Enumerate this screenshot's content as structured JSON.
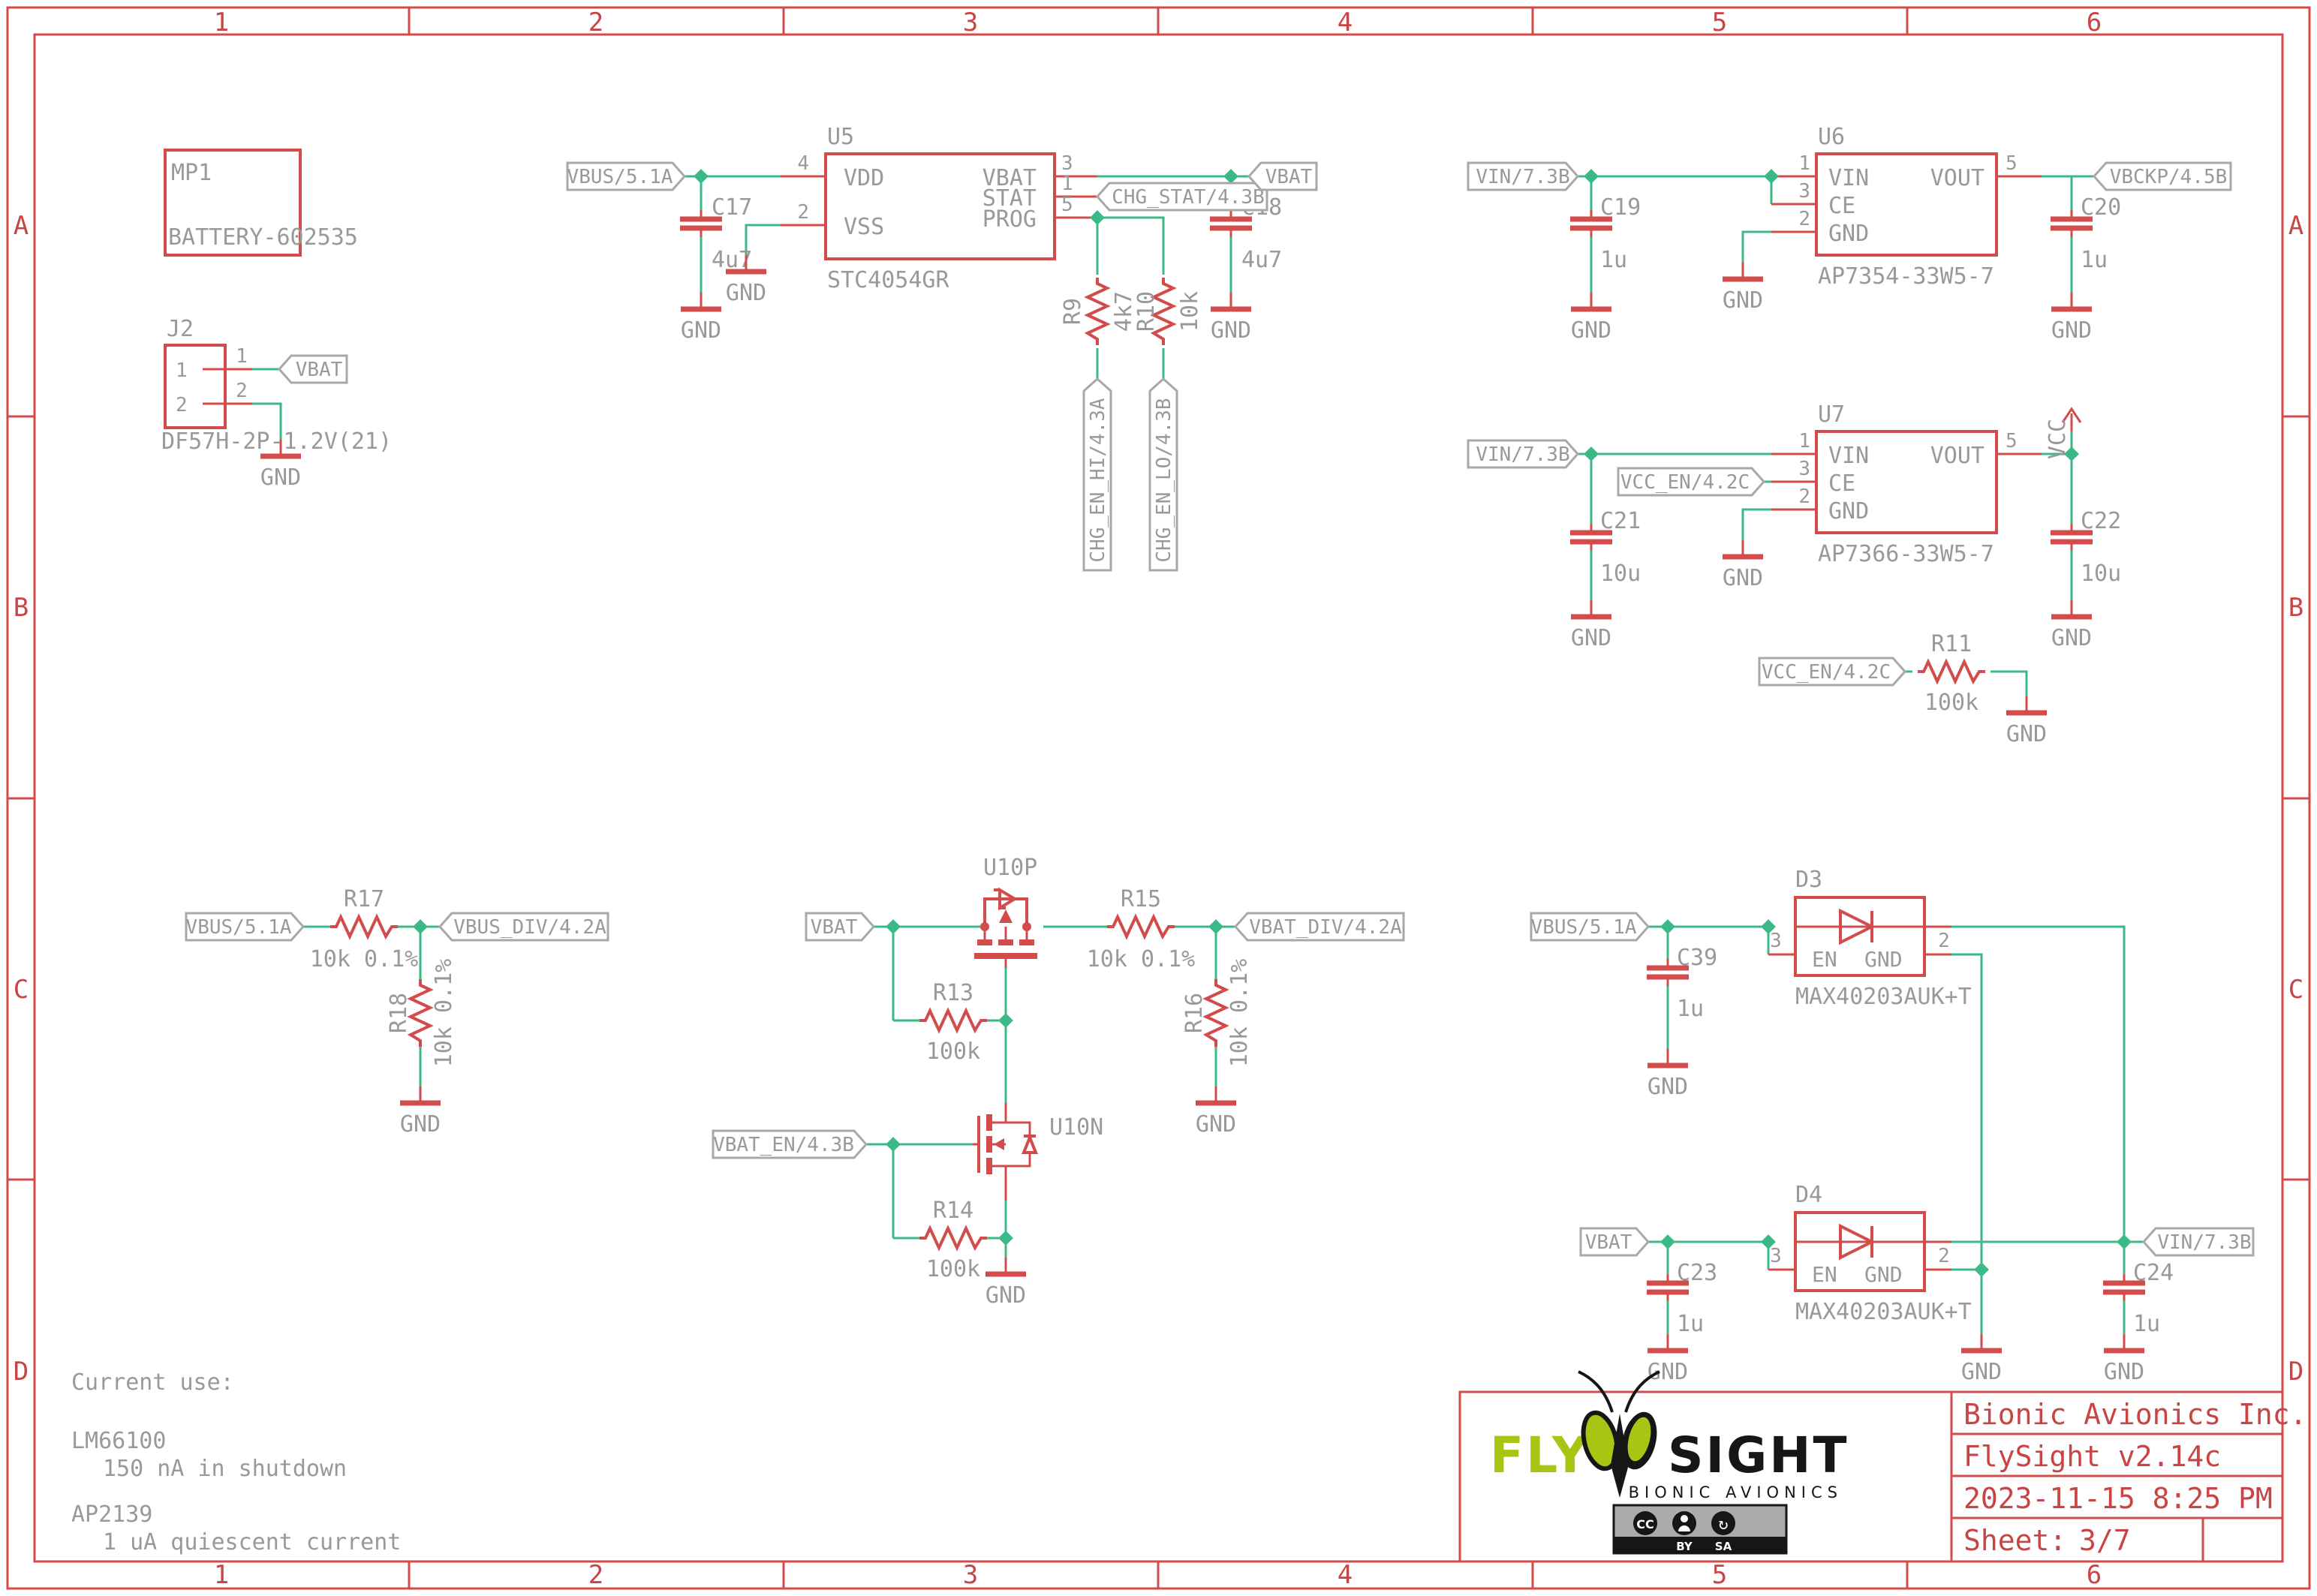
{
  "grid": {
    "cols": [
      "1",
      "2",
      "3",
      "4",
      "5",
      "6"
    ],
    "rows": [
      "A",
      "B",
      "C",
      "D"
    ]
  },
  "nets": {
    "vbus": "VBUS/5.1A",
    "vbat": "VBAT",
    "vbus_div": "VBUS_DIV/4.2A",
    "vbat_div": "VBAT_DIV/4.2A",
    "vbat_en": "VBAT_EN/4.3B",
    "chg_stat": "CHG_STAT/4.3B",
    "chg_en_hi": "CHG_EN_HI/4.3A",
    "chg_en_lo": "CHG_EN_LO/4.3B",
    "vin": "VIN/7.3B",
    "vbckp": "VBCKP/4.5B",
    "vcc_en": "VCC_EN/4.2C",
    "vcc": "VCC",
    "gnd": "GND"
  },
  "components": {
    "mp1": {
      "ref": "MP1",
      "value": "BATTERY-602535"
    },
    "j2": {
      "ref": "J2",
      "value": "DF57H-2P-1.2V(21)",
      "pin1": "1",
      "pin2": "2"
    },
    "u5": {
      "ref": "U5",
      "value": "STC4054GR",
      "pin_vdd": "VDD",
      "pin_vss": "VSS",
      "pin_vbat": "VBAT",
      "pin_stat": "STAT",
      "pin_prog": "PROG",
      "num_vdd": "4",
      "num_vss": "2",
      "num_vbat": "3",
      "num_stat": "1",
      "num_prog": "5"
    },
    "u6": {
      "ref": "U6",
      "value": "AP7354-33W5-7",
      "pin_vin": "VIN",
      "pin_ce": "CE",
      "pin_gnd": "GND",
      "pin_vout": "VOUT",
      "num_vin": "1",
      "num_ce": "3",
      "num_gnd": "2",
      "num_vout": "5"
    },
    "u7": {
      "ref": "U7",
      "value": "AP7366-33W5-7",
      "pin_vin": "VIN",
      "pin_ce": "CE",
      "pin_gnd": "GND",
      "pin_vout": "VOUT",
      "num_vin": "1",
      "num_ce": "3",
      "num_gnd": "2",
      "num_vout": "5"
    },
    "u10p": {
      "ref": "U10P"
    },
    "u10n": {
      "ref": "U10N"
    },
    "d3": {
      "ref": "D3",
      "value": "MAX40203AUK+T",
      "pin_en": "EN",
      "pin_gnd": "GND",
      "num_en": "3",
      "num_gnd": "2"
    },
    "d4": {
      "ref": "D4",
      "value": "MAX40203AUK+T",
      "pin_en": "EN",
      "pin_gnd": "GND",
      "num_en": "3",
      "num_gnd": "2"
    },
    "r9": {
      "ref": "R9",
      "value": "4k7"
    },
    "r10": {
      "ref": "R10",
      "value": "10k"
    },
    "r11": {
      "ref": "R11",
      "value": "100k"
    },
    "r13": {
      "ref": "R13",
      "value": "100k"
    },
    "r14": {
      "ref": "R14",
      "value": "100k"
    },
    "r15": {
      "ref": "R15",
      "value": "10k 0.1%"
    },
    "r16": {
      "ref": "R16",
      "value": "10k 0.1%"
    },
    "r17": {
      "ref": "R17",
      "value": "10k 0.1%"
    },
    "r18": {
      "ref": "R18",
      "value": "10k 0.1%"
    },
    "c17": {
      "ref": "C17",
      "value": "4u7"
    },
    "c18": {
      "ref": "C18",
      "value": "4u7"
    },
    "c19": {
      "ref": "C19",
      "value": "1u"
    },
    "c20": {
      "ref": "C20",
      "value": "1u"
    },
    "c21": {
      "ref": "C21",
      "value": "10u"
    },
    "c22": {
      "ref": "C22",
      "value": "10u"
    },
    "c23": {
      "ref": "C23",
      "value": "1u"
    },
    "c24": {
      "ref": "C24",
      "value": "1u"
    },
    "c39": {
      "ref": "C39",
      "value": "1u"
    }
  },
  "notes": {
    "title": "Current use:",
    "items": [
      {
        "part": "LM66100",
        "detail": "150 nA in shutdown"
      },
      {
        "part": "AP2139",
        "detail": "1 uA quiescent current"
      }
    ]
  },
  "title_block": {
    "company": "Bionic Avionics Inc.",
    "project": "FlySight v2.14c",
    "date": "2023-11-15 8:25 PM",
    "sheet_label": "Sheet:",
    "sheet_value": "3/7",
    "logo": {
      "fly": "FLY",
      "sight": "SIGHT",
      "tagline": "BIONIC AVIONICS"
    },
    "license": {
      "cc": "CC",
      "by": "BY",
      "sa": "SA"
    }
  },
  "colors": {
    "symbol_red": "#d34c4c",
    "wire_green": "#3bb987",
    "label_gray": "#999999",
    "flag_outline": "#a8a8a8",
    "title_red": "#c94444",
    "logo_green": "#a9c514"
  }
}
